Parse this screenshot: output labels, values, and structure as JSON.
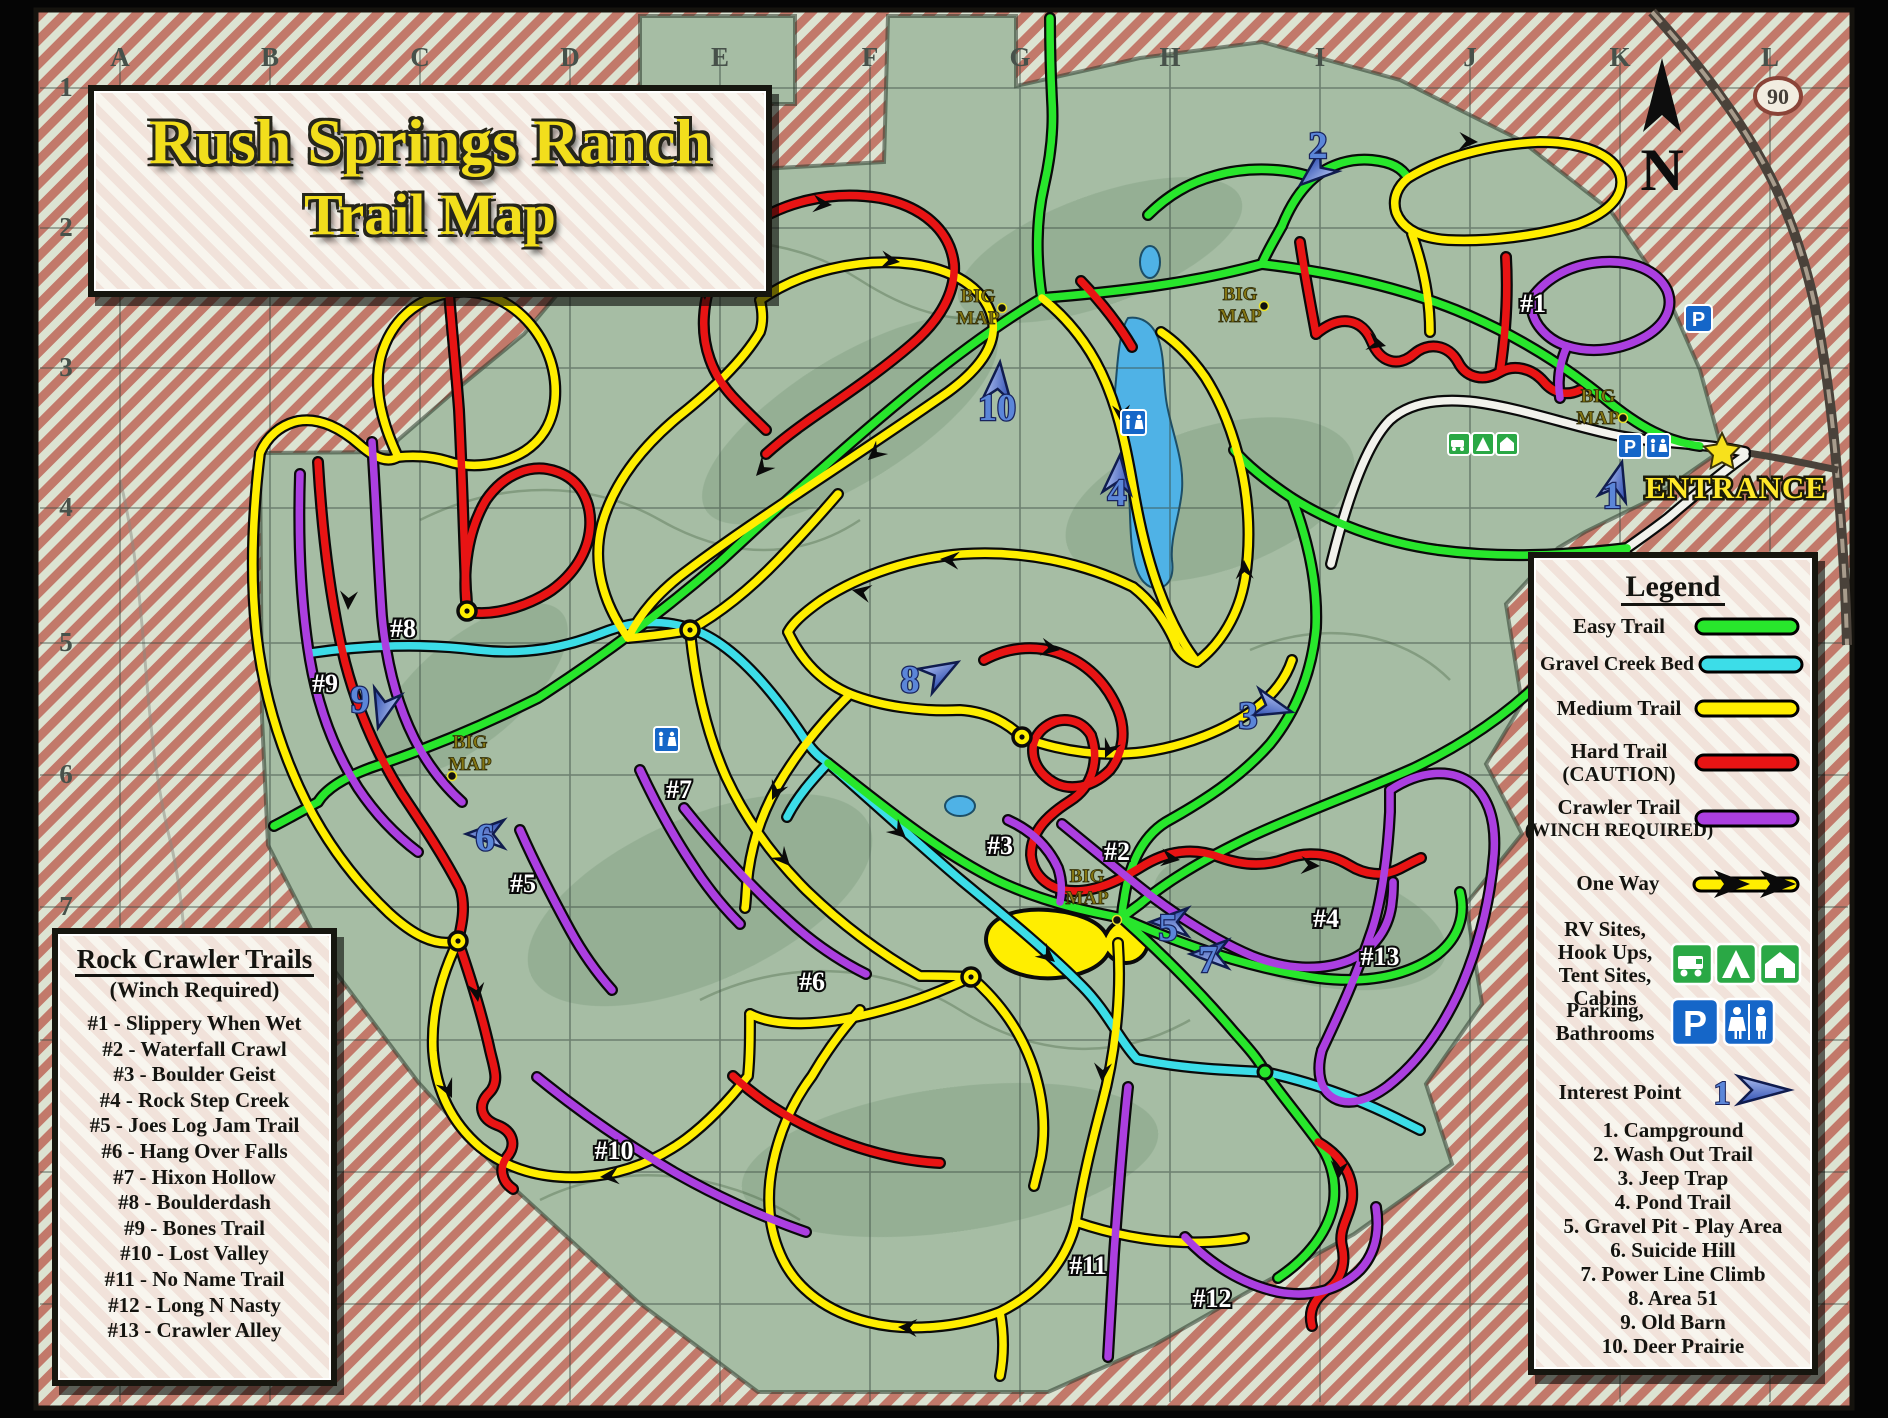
{
  "title": {
    "line1": "Rush Springs Ranch",
    "line2": "Trail Map"
  },
  "entrance": {
    "label": "ENTRANCE"
  },
  "compass": {
    "label": "N"
  },
  "route_shield": {
    "number": "90"
  },
  "grid": {
    "columns": [
      "A",
      "B",
      "C",
      "D",
      "E",
      "F",
      "G",
      "H",
      "I",
      "J",
      "K",
      "L"
    ],
    "rows": [
      "1",
      "2",
      "3",
      "4",
      "5",
      "6",
      "7"
    ]
  },
  "colors": {
    "easy": "#28e62c",
    "creek": "#3cdde8",
    "medium": "#ffee00",
    "hard": "#e81414",
    "crawler": "#ab3fe0",
    "road": "#f2f2ec",
    "interest_blue": "#5b86d8"
  },
  "legend": {
    "title": "Legend",
    "trail_types": [
      {
        "label": "Easy Trail",
        "color": "#28e62c"
      },
      {
        "label": "Gravel Creek Bed",
        "color": "#3cdde8"
      },
      {
        "label": "Medium Trail",
        "color": "#ffee00"
      },
      {
        "label": "Hard Trail",
        "label2": "(CAUTION)",
        "color": "#e81414"
      },
      {
        "label": "Crawler Trail",
        "label2": "(WINCH REQUIRED)",
        "color": "#ab3fe0"
      }
    ],
    "one_way_label": "One Way",
    "rv_lines": [
      "RV Sites,",
      "Hook Ups,",
      "Tent Sites,",
      "Cabins"
    ],
    "parking_lines": [
      "Parking,",
      "Bathrooms"
    ],
    "interest_label": "Interest Point",
    "interest_icon_number": "1",
    "interest_points": [
      "1. Campground",
      "2. Wash Out Trail",
      "3. Jeep Trap",
      "4. Pond Trail",
      "5. Gravel Pit - Play Area",
      "6. Suicide Hill",
      "7. Power Line Climb",
      "8. Area 51",
      "9. Old Barn",
      "10. Deer Prairie"
    ]
  },
  "rock_crawler": {
    "title": "Rock Crawler Trails",
    "subtitle": "(Winch Required)",
    "trails": [
      "#1 - Slippery When Wet",
      "#2 - Waterfall Crawl",
      "#3 - Boulder Geist",
      "#4 - Rock Step Creek",
      "#5 - Joes Log Jam Trail",
      "#6 - Hang Over Falls",
      "#7 - Hixon Hollow",
      "#8 - Boulderdash",
      "#9 - Bones Trail",
      "#10 - Lost Valley",
      "#11 - No Name Trail",
      "#12 - Long N Nasty",
      "#13 - Crawler Alley"
    ]
  },
  "map": {
    "big_map": {
      "line1": "BIG",
      "line2": "MAP"
    },
    "trail_labels": [
      "#1",
      "#2",
      "#3",
      "#4",
      "#5",
      "#6",
      "#7",
      "#8",
      "#9",
      "#10",
      "#11",
      "#12",
      "#13"
    ],
    "markers": [
      "1",
      "2",
      "3",
      "4",
      "5",
      "6",
      "7",
      "8",
      "9",
      "10"
    ],
    "parking_letter": "P"
  }
}
